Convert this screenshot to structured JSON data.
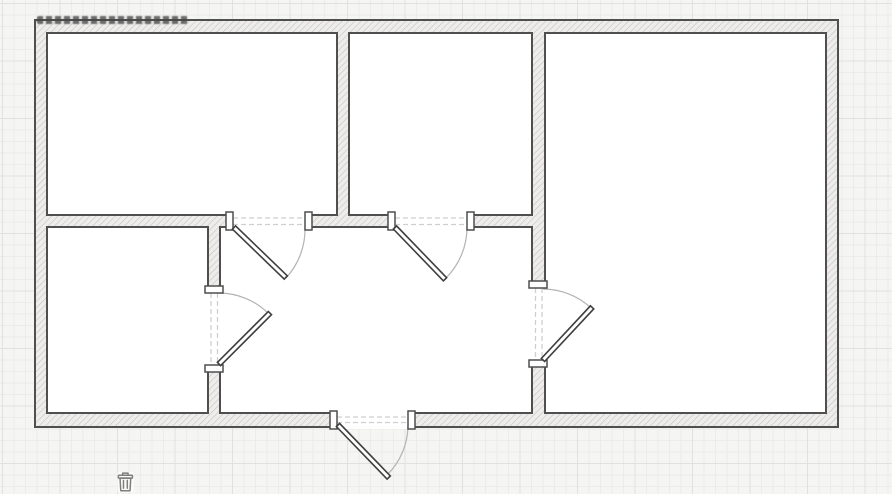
{
  "canvas": {
    "width": 892,
    "height": 494
  },
  "theme": {
    "background": "#f5f5f3",
    "grid_minor": "#ececea",
    "grid_major": "#e1e1df",
    "room_fill": "#ffffff",
    "wall_fill": "#eeedeb",
    "wall_hatch": "#c3c3c1",
    "wall_stroke": "#4f4f4f",
    "jamb_stroke": "#4f4f4f",
    "arc_stroke": "#b3b3b1",
    "dash_stroke": "#cfcfcd",
    "icon_color": "#7e7e7e",
    "watermark_color": "#484848"
  },
  "floorplan": {
    "outer_wall": {
      "x1": 35,
      "y1": 20,
      "x2": 838,
      "y2": 427
    },
    "rooms": [
      {
        "id": "room-top-left",
        "x1": 47,
        "y1": 33,
        "x2": 337,
        "y2": 215
      },
      {
        "id": "room-top-middle",
        "x1": 349,
        "y1": 33,
        "x2": 532,
        "y2": 215
      },
      {
        "id": "room-right",
        "x1": 545,
        "y1": 33,
        "x2": 826,
        "y2": 413
      },
      {
        "id": "room-bottom-left",
        "x1": 47,
        "y1": 227,
        "x2": 208,
        "y2": 413
      },
      {
        "id": "hall",
        "x1": 220,
        "y1": 227,
        "x2": 532,
        "y2": 413
      }
    ],
    "doors": [
      {
        "id": "door-room-top-left",
        "opening": {
          "x": 233,
          "y": 212,
          "w": 72,
          "h": 18
        },
        "dashes": [
          [
            233,
            218,
            305,
            218
          ],
          [
            233,
            224.5,
            305,
            224.5
          ]
        ],
        "jambs": [
          {
            "x": 226,
            "y": 212,
            "w": 7,
            "h": 18
          },
          {
            "x": 305,
            "y": 212,
            "w": 7,
            "h": 18
          }
        ],
        "panel": {
          "len": 72,
          "th": 4.5,
          "angle": 44,
          "cx": 234,
          "cy": 227.5
        },
        "arc": "M 305 227 A 72 72 0 0 1 286 278"
      },
      {
        "id": "door-room-top-middle",
        "opening": {
          "x": 395,
          "y": 212,
          "w": 72,
          "h": 18
        },
        "dashes": [
          [
            395,
            218,
            467,
            218
          ],
          [
            395,
            224.5,
            467,
            224.5
          ]
        ],
        "jambs": [
          {
            "x": 388,
            "y": 212,
            "w": 7,
            "h": 18
          },
          {
            "x": 467,
            "y": 212,
            "w": 7,
            "h": 18
          }
        ],
        "panel": {
          "len": 72,
          "th": 4.5,
          "angle": 46,
          "cx": 395,
          "cy": 227.5
        },
        "arc": "M 467 227 A 72 72 0 0 1 445 279"
      },
      {
        "id": "door-room-bottom-left",
        "opening": {
          "x": 205,
          "y": 293,
          "w": 18,
          "h": 72
        },
        "dashes": [
          [
            211,
            293,
            211,
            365
          ],
          [
            217.5,
            293,
            217.5,
            365
          ]
        ],
        "jambs": [
          {
            "x": 205,
            "y": 286,
            "w": 18,
            "h": 7
          },
          {
            "x": 205,
            "y": 365,
            "w": 18,
            "h": 7
          }
        ],
        "panel": {
          "len": 72,
          "th": 4.5,
          "angle": -45,
          "cx": 219,
          "cy": 364
        },
        "arc": "M 219 293 A 71 71 0 0 1 269 314"
      },
      {
        "id": "door-room-right",
        "opening": {
          "x": 529,
          "y": 288,
          "w": 18,
          "h": 72
        },
        "dashes": [
          [
            535.5,
            288,
            535.5,
            360
          ],
          [
            542,
            288,
            542,
            360
          ]
        ],
        "jambs": [
          {
            "x": 529,
            "y": 281,
            "w": 18,
            "h": 7
          },
          {
            "x": 529,
            "y": 360,
            "w": 18,
            "h": 7
          }
        ],
        "panel": {
          "len": 72,
          "th": 4.5,
          "angle": -47,
          "cx": 543,
          "cy": 360
        },
        "arc": "M 543 289 A 71 71 0 0 1 591 308"
      },
      {
        "id": "door-entrance",
        "opening": {
          "x": 337,
          "y": 411,
          "w": 71,
          "h": 18
        },
        "dashes": [
          [
            337,
            417,
            408,
            417
          ],
          [
            337,
            422.5,
            408,
            422.5
          ]
        ],
        "jambs": [
          {
            "x": 330,
            "y": 411,
            "w": 7,
            "h": 18
          },
          {
            "x": 408,
            "y": 411,
            "w": 7,
            "h": 18
          }
        ],
        "panel": {
          "len": 73,
          "th": 4.5,
          "angle": 46,
          "cx": 338,
          "cy": 425
        },
        "arc": "M 408 425 A 70 70 0 0 1 387 475"
      }
    ]
  },
  "overlay": {
    "watermark": {
      "present": true,
      "legible": false,
      "x": 37,
      "y": 16,
      "w": 151,
      "h": 8
    },
    "trash_icon": {
      "x": 117,
      "y": 472,
      "w": 17,
      "h": 20
    }
  }
}
